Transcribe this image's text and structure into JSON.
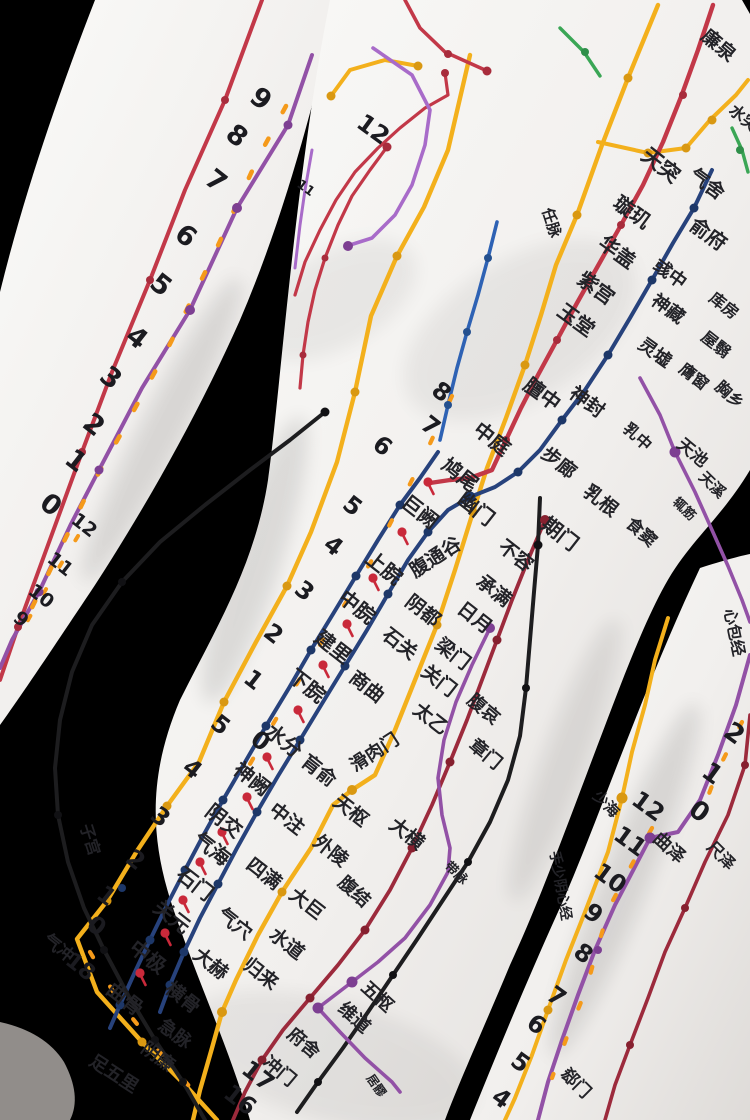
{
  "meta": {
    "title": "Acupuncture meridian mannequin torso (photograph)",
    "description": "White acupuncture model torso on black background, painted meridian lines with Chinese acupoint labels and cun scale numbers"
  },
  "palette": {
    "background": "#000000",
    "body": "#f2f0ee",
    "red": "#c23848",
    "dark_red": "#9c2a3c",
    "yellow": "#f3b01c",
    "orange_tick": "#f59a1a",
    "navy": "#27427c",
    "blue": "#2e62b4",
    "purple": "#9251a6",
    "black_line": "#1d1d1f",
    "green": "#3aa655",
    "text": "#232328"
  },
  "labels": {
    "neck": [
      "廉泉",
      "水突",
      "天突",
      "气舍"
    ],
    "ren": [
      "任脉",
      "璇玑",
      "华盖",
      "紫宫",
      "玉堂",
      "膻中",
      "中庭",
      "鸠尾",
      "巨阙",
      "上脘",
      "中脘",
      "建里",
      "下脘",
      "水分",
      "神阙",
      "阴交",
      "气海",
      "石门",
      "关元",
      "中极",
      "曲骨"
    ],
    "kidney": [
      "俞府",
      "彧中",
      "神藏",
      "灵墟",
      "神封",
      "步廊",
      "幽门",
      "腹通谷",
      "阴都",
      "石关",
      "商曲",
      "肓俞",
      "中注",
      "四满",
      "气穴",
      "大赫",
      "横骨"
    ],
    "stomach": [
      "库房",
      "屋翳",
      "膺窗",
      "乳中",
      "乳根",
      "不容",
      "承满",
      "梁门",
      "关门",
      "太乙",
      "滑肉门",
      "天枢",
      "外陵",
      "大巨",
      "水道",
      "归来",
      "气冲"
    ],
    "spleen": [
      "食窦",
      "天溪",
      "胸乡",
      "腹哀",
      "大横",
      "腹结",
      "府舍",
      "冲门"
    ],
    "liver": [
      "期门",
      "章门",
      "急脉",
      "阴廉",
      "足五里"
    ],
    "gallbladder": [
      "辄筋",
      "日月",
      "带脉",
      "五枢",
      "维道",
      "居髎"
    ],
    "pericardium": [
      "天池",
      "曲泽",
      "郄门",
      "心包经"
    ],
    "heart": [
      "少海",
      "手少阴心经"
    ],
    "lung": [
      "尺泽"
    ],
    "extra": [
      "子宫"
    ]
  },
  "numbers": {
    "left_arm": [
      "9",
      "8",
      "7",
      "6",
      "5",
      "4",
      "3",
      "2",
      "1",
      "0",
      "12",
      "11",
      "10",
      "9"
    ],
    "chest": [
      "12",
      "11"
    ],
    "center": [
      "8",
      "7",
      "6",
      "5",
      "4",
      "3",
      "2",
      "1",
      "5",
      "0",
      "4",
      "3",
      "2",
      "1",
      "0",
      "18",
      "17",
      "16"
    ],
    "right_arm": [
      "2",
      "1",
      "0",
      "12",
      "11",
      "10",
      "9",
      "8",
      "7",
      "6",
      "5",
      "4"
    ]
  }
}
